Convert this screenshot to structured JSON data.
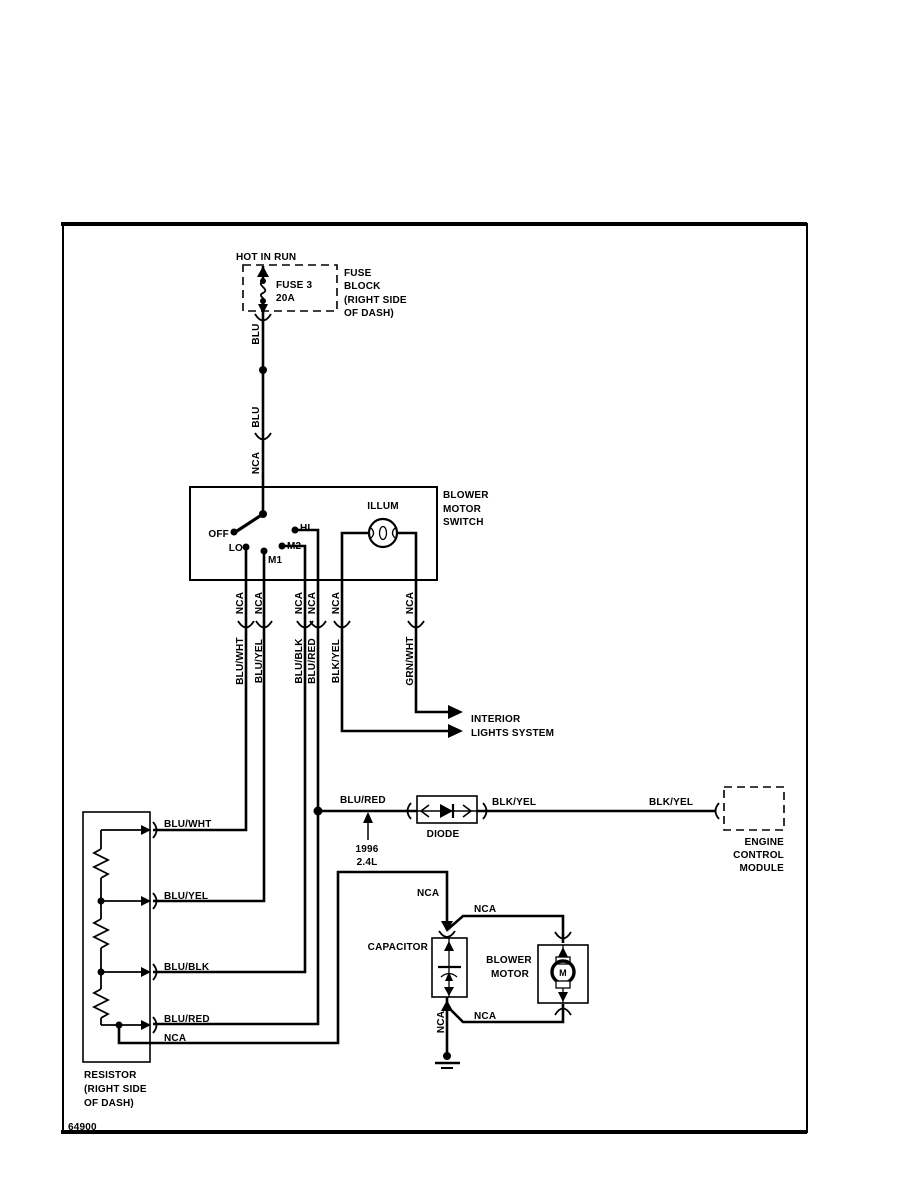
{
  "title_block": {
    "drawing_number": "64900"
  },
  "power": {
    "hot_label": "HOT IN RUN",
    "fuse_name": "FUSE 3",
    "fuse_rating": "20A",
    "block_note_1": "FUSE",
    "block_note_2": "BLOCK",
    "block_note_3": "(RIGHT SIDE",
    "block_note_4": "OF DASH)",
    "wire_color_upper": "BLU",
    "wire_color_lower": "BLU",
    "wire_nca": "NCA"
  },
  "blower_switch": {
    "name_1": "BLOWER",
    "name_2": "MOTOR",
    "name_3": "SWITCH",
    "pos_off": "OFF",
    "pos_lo": "LO",
    "pos_m1": "M1",
    "pos_m2": "M2",
    "pos_hi": "HI",
    "lamp": "ILLUM",
    "output_nca": [
      "NCA",
      "NCA",
      "NCA",
      "NCA",
      "NCA",
      "NCA"
    ],
    "output_colors": [
      "BLU/WHT",
      "BLU/YEL",
      "BLU/BLK",
      "BLU/RED",
      "BLK/YEL",
      "GRN/WHT"
    ]
  },
  "interior_lights": {
    "line_1": "INTERIOR",
    "line_2": "LIGHTS SYSTEM"
  },
  "diode_branch": {
    "wire_in": "BLU/RED",
    "component": "DIODE",
    "wire_out": "BLK/YEL",
    "wire_out_far": "BLK/YEL",
    "variant_year": "1996",
    "variant_engine": "2.4L"
  },
  "ecm": {
    "line_1": "ENGINE",
    "line_2": "CONTROL",
    "line_3": "MODULE"
  },
  "resistor": {
    "tap_colors": [
      "BLU/WHT",
      "BLU/YEL",
      "BLU/BLK",
      "BLU/RED"
    ],
    "tap_nca": "NCA",
    "note_1": "RESISTOR",
    "note_2": "(RIGHT SIDE",
    "note_3": "OF DASH)"
  },
  "capacitor": {
    "label": "CAPACITOR",
    "feed_nca": "NCA",
    "ground_nca": "NCA"
  },
  "blower_motor": {
    "name_1": "BLOWER",
    "name_2": "MOTOR",
    "symbol": "M",
    "top_nca": "NCA",
    "bottom_nca": "NCA"
  }
}
